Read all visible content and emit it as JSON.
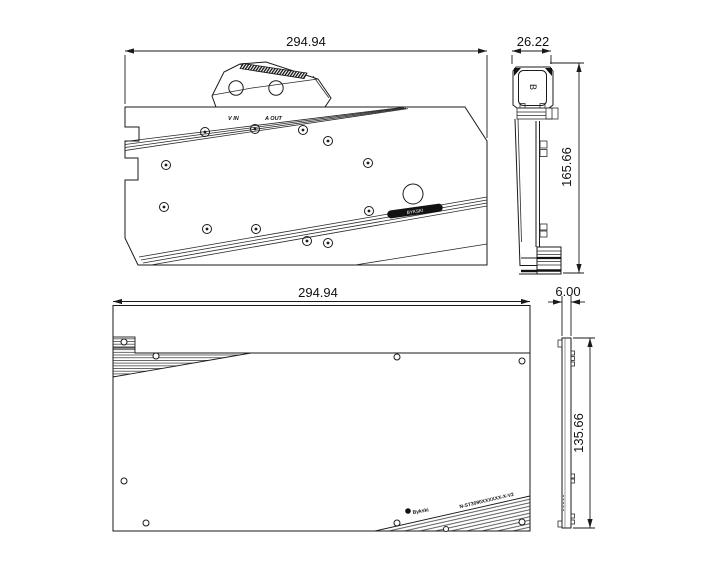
{
  "views": {
    "front": {
      "width_dim": "294.94",
      "inlet_label": "V IN",
      "outlet_label": "A OUT",
      "engraving": "BYKSKI"
    },
    "front_side": {
      "width_dim": "26.22",
      "height_dim": "165.66",
      "port_mark": "B"
    },
    "back": {
      "width_dim": "294.94",
      "brand": "Bykski",
      "model": "N-ST3090XXXXXX-X-V2"
    },
    "back_side": {
      "width_dim": "6.00",
      "height_dim": "135.66"
    }
  },
  "colors": {
    "line": "#1a1a1a",
    "engraving_bg": "#111111",
    "background": "#ffffff"
  }
}
